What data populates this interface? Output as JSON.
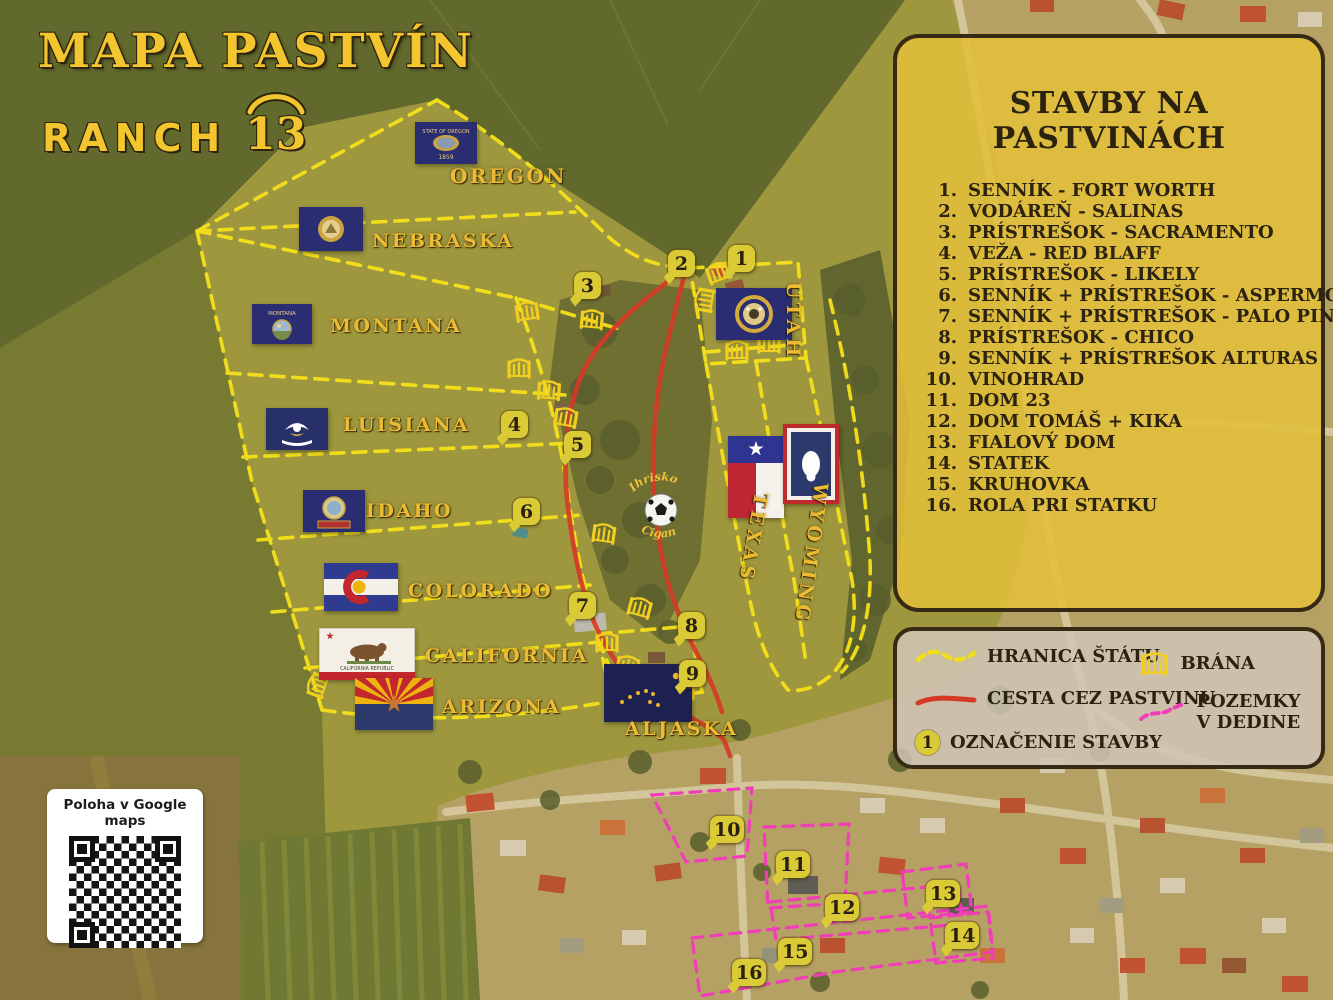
{
  "title": {
    "main": "MAPA PASTVÍN",
    "brand": "RANCH",
    "brand_number": "13"
  },
  "panel": {
    "title": "STAVBY NA PASTVINÁCH",
    "items": [
      {
        "num": "1.",
        "text": "SENNÍK - FORT WORTH"
      },
      {
        "num": "2.",
        "text": "VODÁREŇ - SALINAS"
      },
      {
        "num": "3.",
        "text": "PRÍSTREŠOK - SACRAMENTO"
      },
      {
        "num": "4.",
        "text": "VEŽA - RED BLAFF"
      },
      {
        "num": "5.",
        "text": "PRÍSTREŠOK - LIKELY"
      },
      {
        "num": "6.",
        "text": "SENNÍK + PRÍSTREŠOK - ASPERMONT"
      },
      {
        "num": "7.",
        "text": "SENNÍK + PRÍSTREŠOK - PALO PINTO"
      },
      {
        "num": "8.",
        "text": "PRÍSTREŠOK - CHICO"
      },
      {
        "num": "9.",
        "text": "SENNÍK + PRÍSTREŠOK ALTURAS"
      },
      {
        "num": "10.",
        "text": "VINOHRAD"
      },
      {
        "num": "11.",
        "text": "DOM 23"
      },
      {
        "num": "12.",
        "text": "DOM TOMÁŠ + KIKA"
      },
      {
        "num": "13.",
        "text": "FIALOVÝ DOM"
      },
      {
        "num": "14.",
        "text": "STATEK"
      },
      {
        "num": "15.",
        "text": "KRUHOVKA"
      },
      {
        "num": "16.",
        "text": "ROLA PRI STATKU"
      }
    ]
  },
  "symbols": {
    "hranica": "HRANICA ŠTÁTU",
    "cesta": "CESTA CEZ PASTVINU",
    "oznacenie": "OZNAČENIE STAVBY",
    "oznacenie_badge": "1",
    "brana": "BRÁNA",
    "pozemky_line1": "POZEMKY",
    "pozemky_line2": "V DEDINE"
  },
  "qr": {
    "label": "Poloha v Google maps"
  },
  "map_labels": {
    "oregon": "OREGON",
    "nebraska": "NEBRASKA",
    "montana": "MONTANA",
    "luisiana": "LUISIANA",
    "idaho": "IDAHO",
    "colorado": "COLORADO",
    "california": "CALIFORNIA",
    "arizona": "ARIZONA",
    "utah": "UTAH",
    "texas": "TEXAS",
    "wyoming": "WYOMING",
    "aljaska": "ALJASKA",
    "ihrisko_top": "Ihrisko",
    "ihrisko_bottom": "Cigan"
  },
  "flags": {
    "oregon_text": "STATE OF OREGON",
    "oregon_year": "1859",
    "montana_text": "MONTANA",
    "california_text": "CALIFORNIA REPUBLIC"
  },
  "markers": [
    {
      "n": "1"
    },
    {
      "n": "2"
    },
    {
      "n": "3"
    },
    {
      "n": "4"
    },
    {
      "n": "5"
    },
    {
      "n": "6"
    },
    {
      "n": "7"
    },
    {
      "n": "8"
    },
    {
      "n": "9"
    },
    {
      "n": "10"
    },
    {
      "n": "11"
    },
    {
      "n": "12"
    },
    {
      "n": "13"
    },
    {
      "n": "14"
    },
    {
      "n": "15"
    },
    {
      "n": "16"
    }
  ],
  "colors": {
    "boundary_yellow": "#f6e11a",
    "road_red": "#d63a26",
    "village_parcel_pink": "#f23db8",
    "badge_yellow": "#d9ca36",
    "title_gold": "#f3c52f",
    "panel_fill": "#e2bf3b",
    "legend_text": "#2c2210"
  }
}
